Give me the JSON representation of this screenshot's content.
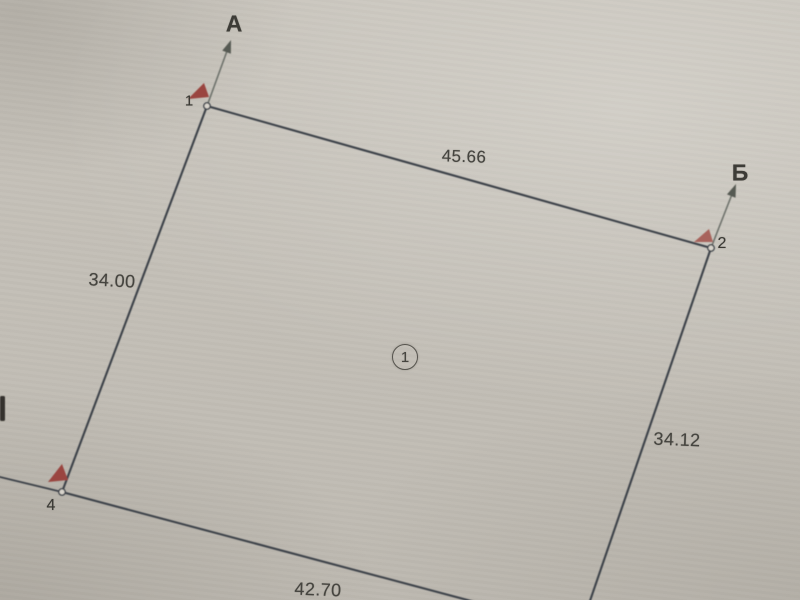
{
  "page": {
    "description": "Scanned cadastral survey sketch of a land parcel",
    "paper_color": "#cbc7bf"
  },
  "plan": {
    "parcel_number": "1",
    "direction_labels": {
      "a": "А",
      "b": "Б"
    },
    "point_labels": {
      "p1": "1",
      "p2": "2",
      "p4": "4"
    },
    "dimensions": {
      "top": "45.66",
      "left": "34.00",
      "right": "34.12",
      "bottom": "42.70"
    },
    "sides": [
      {
        "between": [
          "1",
          "2"
        ],
        "length": "45.66"
      },
      {
        "between": [
          "1",
          "4"
        ],
        "length": "34.00"
      },
      {
        "between": [
          "2",
          "3"
        ],
        "length": "34.12"
      },
      {
        "between": [
          "4",
          "3"
        ],
        "length": "42.70"
      }
    ],
    "colors": {
      "boundary_line": "#3e434a",
      "arrow_line": "#6e726c",
      "arrow_head": "#565a52",
      "flag_red": "#9a453f",
      "flag_red_faded": "#a8635b",
      "text": "#45443f",
      "marker_fill": "#d8d4cc"
    },
    "geometry": {
      "points": {
        "p1": [
          207,
          106
        ],
        "p2": [
          711,
          248
        ],
        "p3": [
          580,
          630
        ],
        "p4": [
          62,
          492
        ]
      },
      "boundary_edges": [
        [
          "p1",
          "p2"
        ],
        [
          "p2",
          "p3"
        ],
        [
          "p4",
          "p3"
        ],
        [
          "p1",
          "p4"
        ]
      ],
      "extension_line": [
        [
          62,
          492
        ],
        [
          0,
          477
        ]
      ],
      "arrows": [
        {
          "label_key": "a",
          "from": [
            207,
            106
          ],
          "to": [
            231,
            40
          ]
        },
        {
          "label_key": "b",
          "from": [
            711,
            248
          ],
          "to": [
            736,
            184
          ]
        }
      ],
      "flags": [
        {
          "points": "188,99 204,83 209,97",
          "color_key": "flag_red"
        },
        {
          "points": "694,242 709,229 713,242",
          "color_key": "flag_red_faded"
        },
        {
          "points": "48,482 62,464 68,480",
          "color_key": "flag_red"
        }
      ],
      "markers": [
        "p1",
        "p2",
        "p4"
      ],
      "clipped_mark": {
        "x": 0,
        "y": 396,
        "w": 5,
        "h": 25
      }
    }
  }
}
